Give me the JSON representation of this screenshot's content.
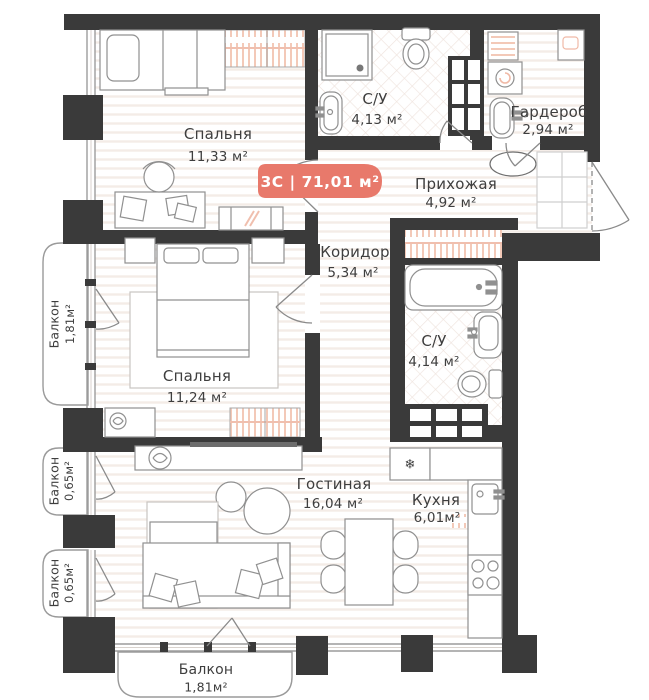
{
  "plan": {
    "badge": {
      "label": "3С | 71,01 м²",
      "color": "#e8796b"
    },
    "rooms": [
      {
        "id": "bedroom-1",
        "name": "Спальня",
        "area": "11,33 м²"
      },
      {
        "id": "bathroom-1",
        "name": "С/У",
        "area": "4,13 м²"
      },
      {
        "id": "wardrobe",
        "name": "Гардероб",
        "area": "2,94 м²"
      },
      {
        "id": "hallway",
        "name": "Прихожая",
        "area": "4,92 м²"
      },
      {
        "id": "corridor",
        "name": "Коридор",
        "area": "5,34 м²"
      },
      {
        "id": "bedroom-2",
        "name": "Спальня",
        "area": "11,24 м²"
      },
      {
        "id": "bathroom-2",
        "name": "С/У",
        "area": "4,14 м²"
      },
      {
        "id": "living-room",
        "name": "Гостиная",
        "area": "16,04 м²"
      },
      {
        "id": "kitchen",
        "name": "Кухня",
        "area": "6,01м²"
      },
      {
        "id": "balcony-left",
        "name": "Балкон",
        "area": "1,81м²"
      },
      {
        "id": "balcony-small-1",
        "name": "Балкон",
        "area": "0,65м²"
      },
      {
        "id": "balcony-small-2",
        "name": "Балкон",
        "area": "0,65м²"
      },
      {
        "id": "balcony-bottom",
        "name": "Балкон",
        "area": "1,81м²"
      }
    ],
    "icons": {
      "fridge_snowflake": "❄"
    },
    "colors": {
      "wall": "#3a3a3a",
      "accent": "#e8796b",
      "hatch": "#f3c9b8",
      "floor_stripe": "#f4ece7",
      "tile_line": "#efe4de",
      "furniture_stroke": "#909090",
      "window_stroke": "#9c9c9c"
    }
  }
}
